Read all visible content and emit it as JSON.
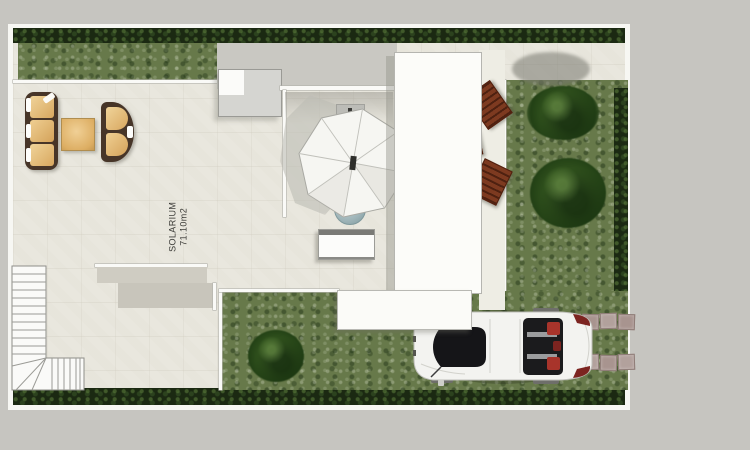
{
  "plan": {
    "title": "villa-roof-terrace-site-plan",
    "room_label": {
      "name": "SOLARIUM",
      "area": "71.10m2"
    },
    "objects": [
      "boundary-hedge",
      "lawn",
      "garden-tree",
      "shrub",
      "sofa",
      "coffee-table",
      "lounge-chair",
      "parasol",
      "round-table",
      "sunbed",
      "skylight",
      "staircase",
      "sun-lounger",
      "side-table",
      "porch-roof",
      "walkway",
      "stepping-stones",
      "car"
    ],
    "colors": {
      "margin_gray": "#c6c5c0",
      "terrace_cream": "#e9e7de",
      "grass_green": "#67794a",
      "hedge_dark": "#1b2912",
      "tree_green": "#30511d",
      "wood_brown": "#7d3a20",
      "cushion_tan": "#e7c084",
      "frame_brown": "#473528",
      "car_body_white": "#f3f3f0",
      "car_red_accent": "#a8342b",
      "paver_pink": "#b2a19c",
      "shadow_gray": "#b8b7b0",
      "pool_table_blue": "#9eb4b8"
    }
  }
}
